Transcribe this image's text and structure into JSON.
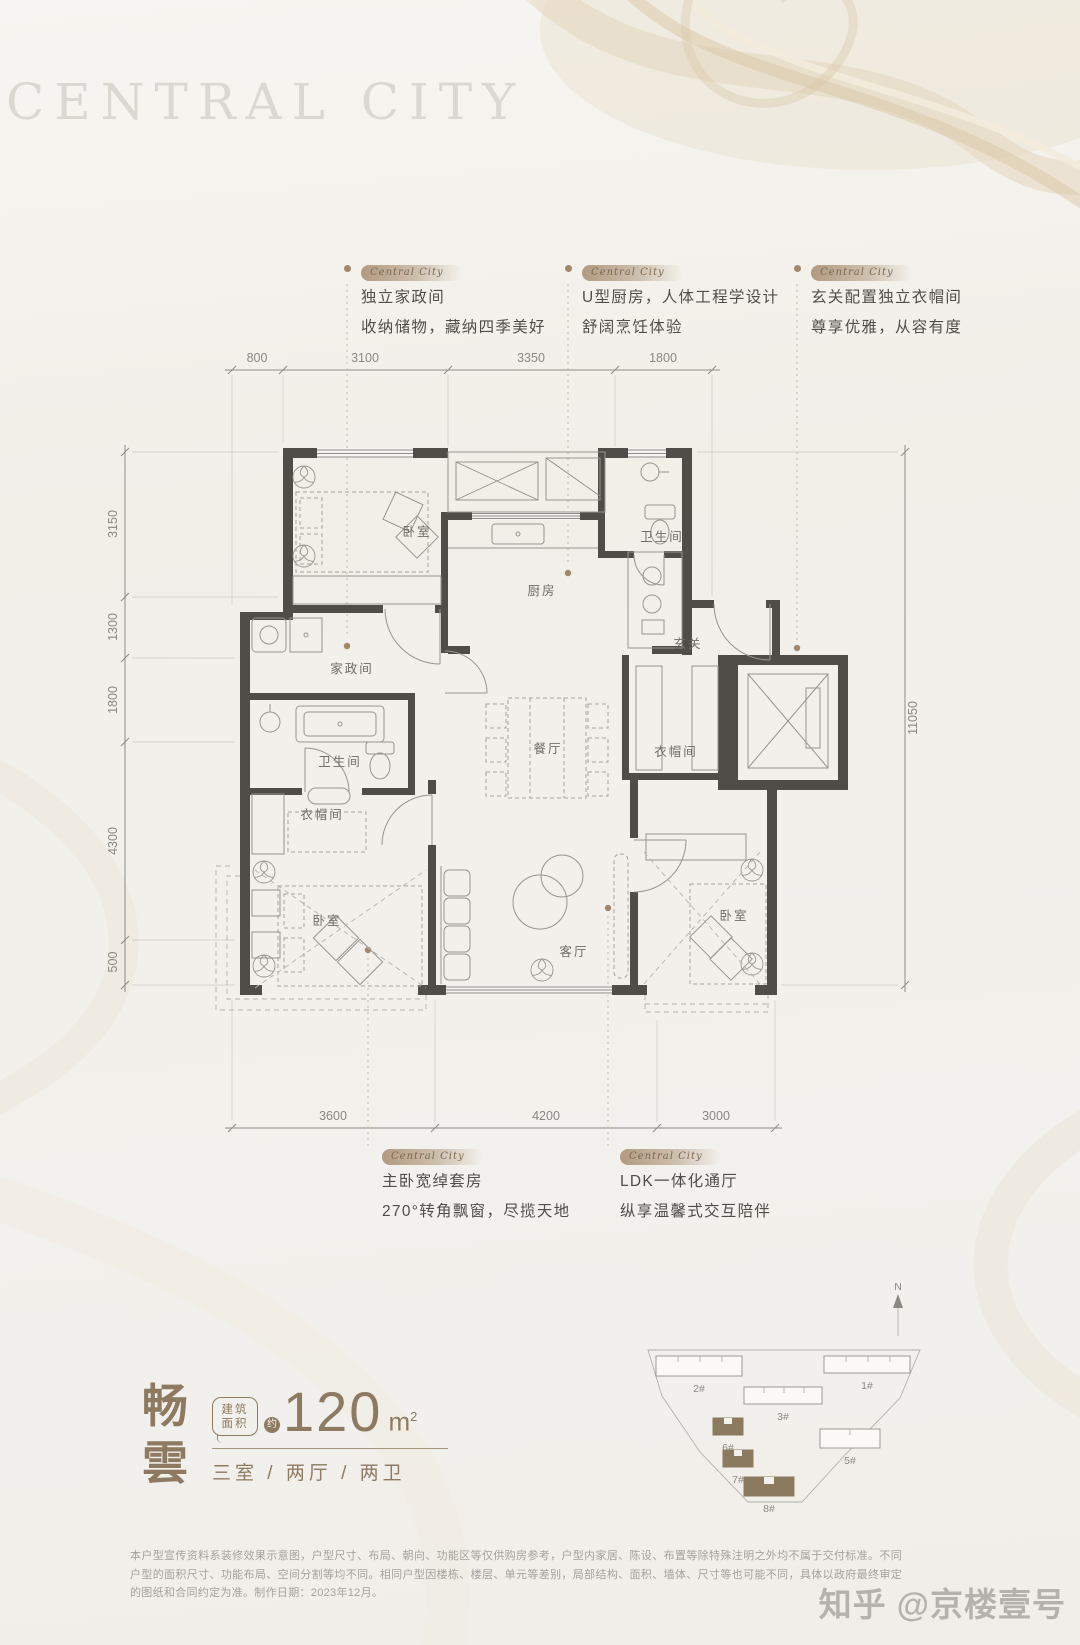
{
  "colors": {
    "accent_brown": "#8d7a61",
    "wall": "#504c48",
    "highlight_building": "#8c7a5f",
    "callout_dot": "#a3876a",
    "background": "#f3f1ed"
  },
  "watermarks": {
    "top": "CENTRAL CITY",
    "bottom": "知乎 @京楼壹号"
  },
  "callout_badge": "Central City",
  "callouts_top": [
    {
      "line1": "独立家政间",
      "line2": "收纳储物，藏纳四季美好"
    },
    {
      "line1": "U型厨房，人体工程学设计",
      "line2": "舒阔烹饪体验"
    },
    {
      "line1": "玄关配置独立衣帽间",
      "line2": "尊享优雅，从容有度"
    }
  ],
  "callouts_bottom": [
    {
      "line1": "主卧宽绰套房",
      "line2": "270°转角飘窗，尽揽天地"
    },
    {
      "line1": "LDK一体化通厅",
      "line2": "纵享温馨式交互陪伴"
    }
  ],
  "dimensions": {
    "top": [
      "800",
      "3100",
      "3350",
      "1800"
    ],
    "left": [
      "3150",
      "1300",
      "1800",
      "4300",
      "500"
    ],
    "right": [
      "11050"
    ],
    "bottom": [
      "3600",
      "4200",
      "3000"
    ]
  },
  "rooms": {
    "bedroom_tl": "卧室",
    "kitchen": "厨房",
    "bath_tr": "卫生间",
    "laundry": "家政间",
    "foyer": "玄关",
    "dining": "餐厅",
    "bath_l": "卫生间",
    "cloak_l": "衣帽间",
    "master": "卧室",
    "living": "客厅",
    "bedroom_br": "卧室",
    "cloak_r": "衣帽间"
  },
  "title_block": {
    "name_line1": "畅",
    "name_line2": "雲",
    "area_label_1": "建筑",
    "area_label_2": "面积",
    "approx": "约",
    "area_value": "120",
    "area_unit": "m",
    "area_sup": "2",
    "specs": "三室 / 两厅 / 两卫"
  },
  "site_plan": {
    "north": "N",
    "buildings": [
      {
        "label": "2#",
        "highlighted": false
      },
      {
        "label": "1#",
        "highlighted": false
      },
      {
        "label": "3#",
        "highlighted": false
      },
      {
        "label": "6#",
        "highlighted": true
      },
      {
        "label": "5#",
        "highlighted": false
      },
      {
        "label": "7#",
        "highlighted": true
      },
      {
        "label": "8#",
        "highlighted": true
      }
    ]
  },
  "disclaimer": "本户型宣传资料系装修效果示意图，户型尺寸、布局、朝向、功能区等仅供购房参考，户型内家居、陈设、布置等除特殊注明之外均不属于交付标准。不同户型的面积尺寸、功能布局、空间分割等均不同。相同户型因楼栋、楼层、单元等差别，局部结构、面积、墙体、尺寸等也可能不同，具体以政府最终审定的图纸和合同约定为准。制作日期：2023年12月。"
}
